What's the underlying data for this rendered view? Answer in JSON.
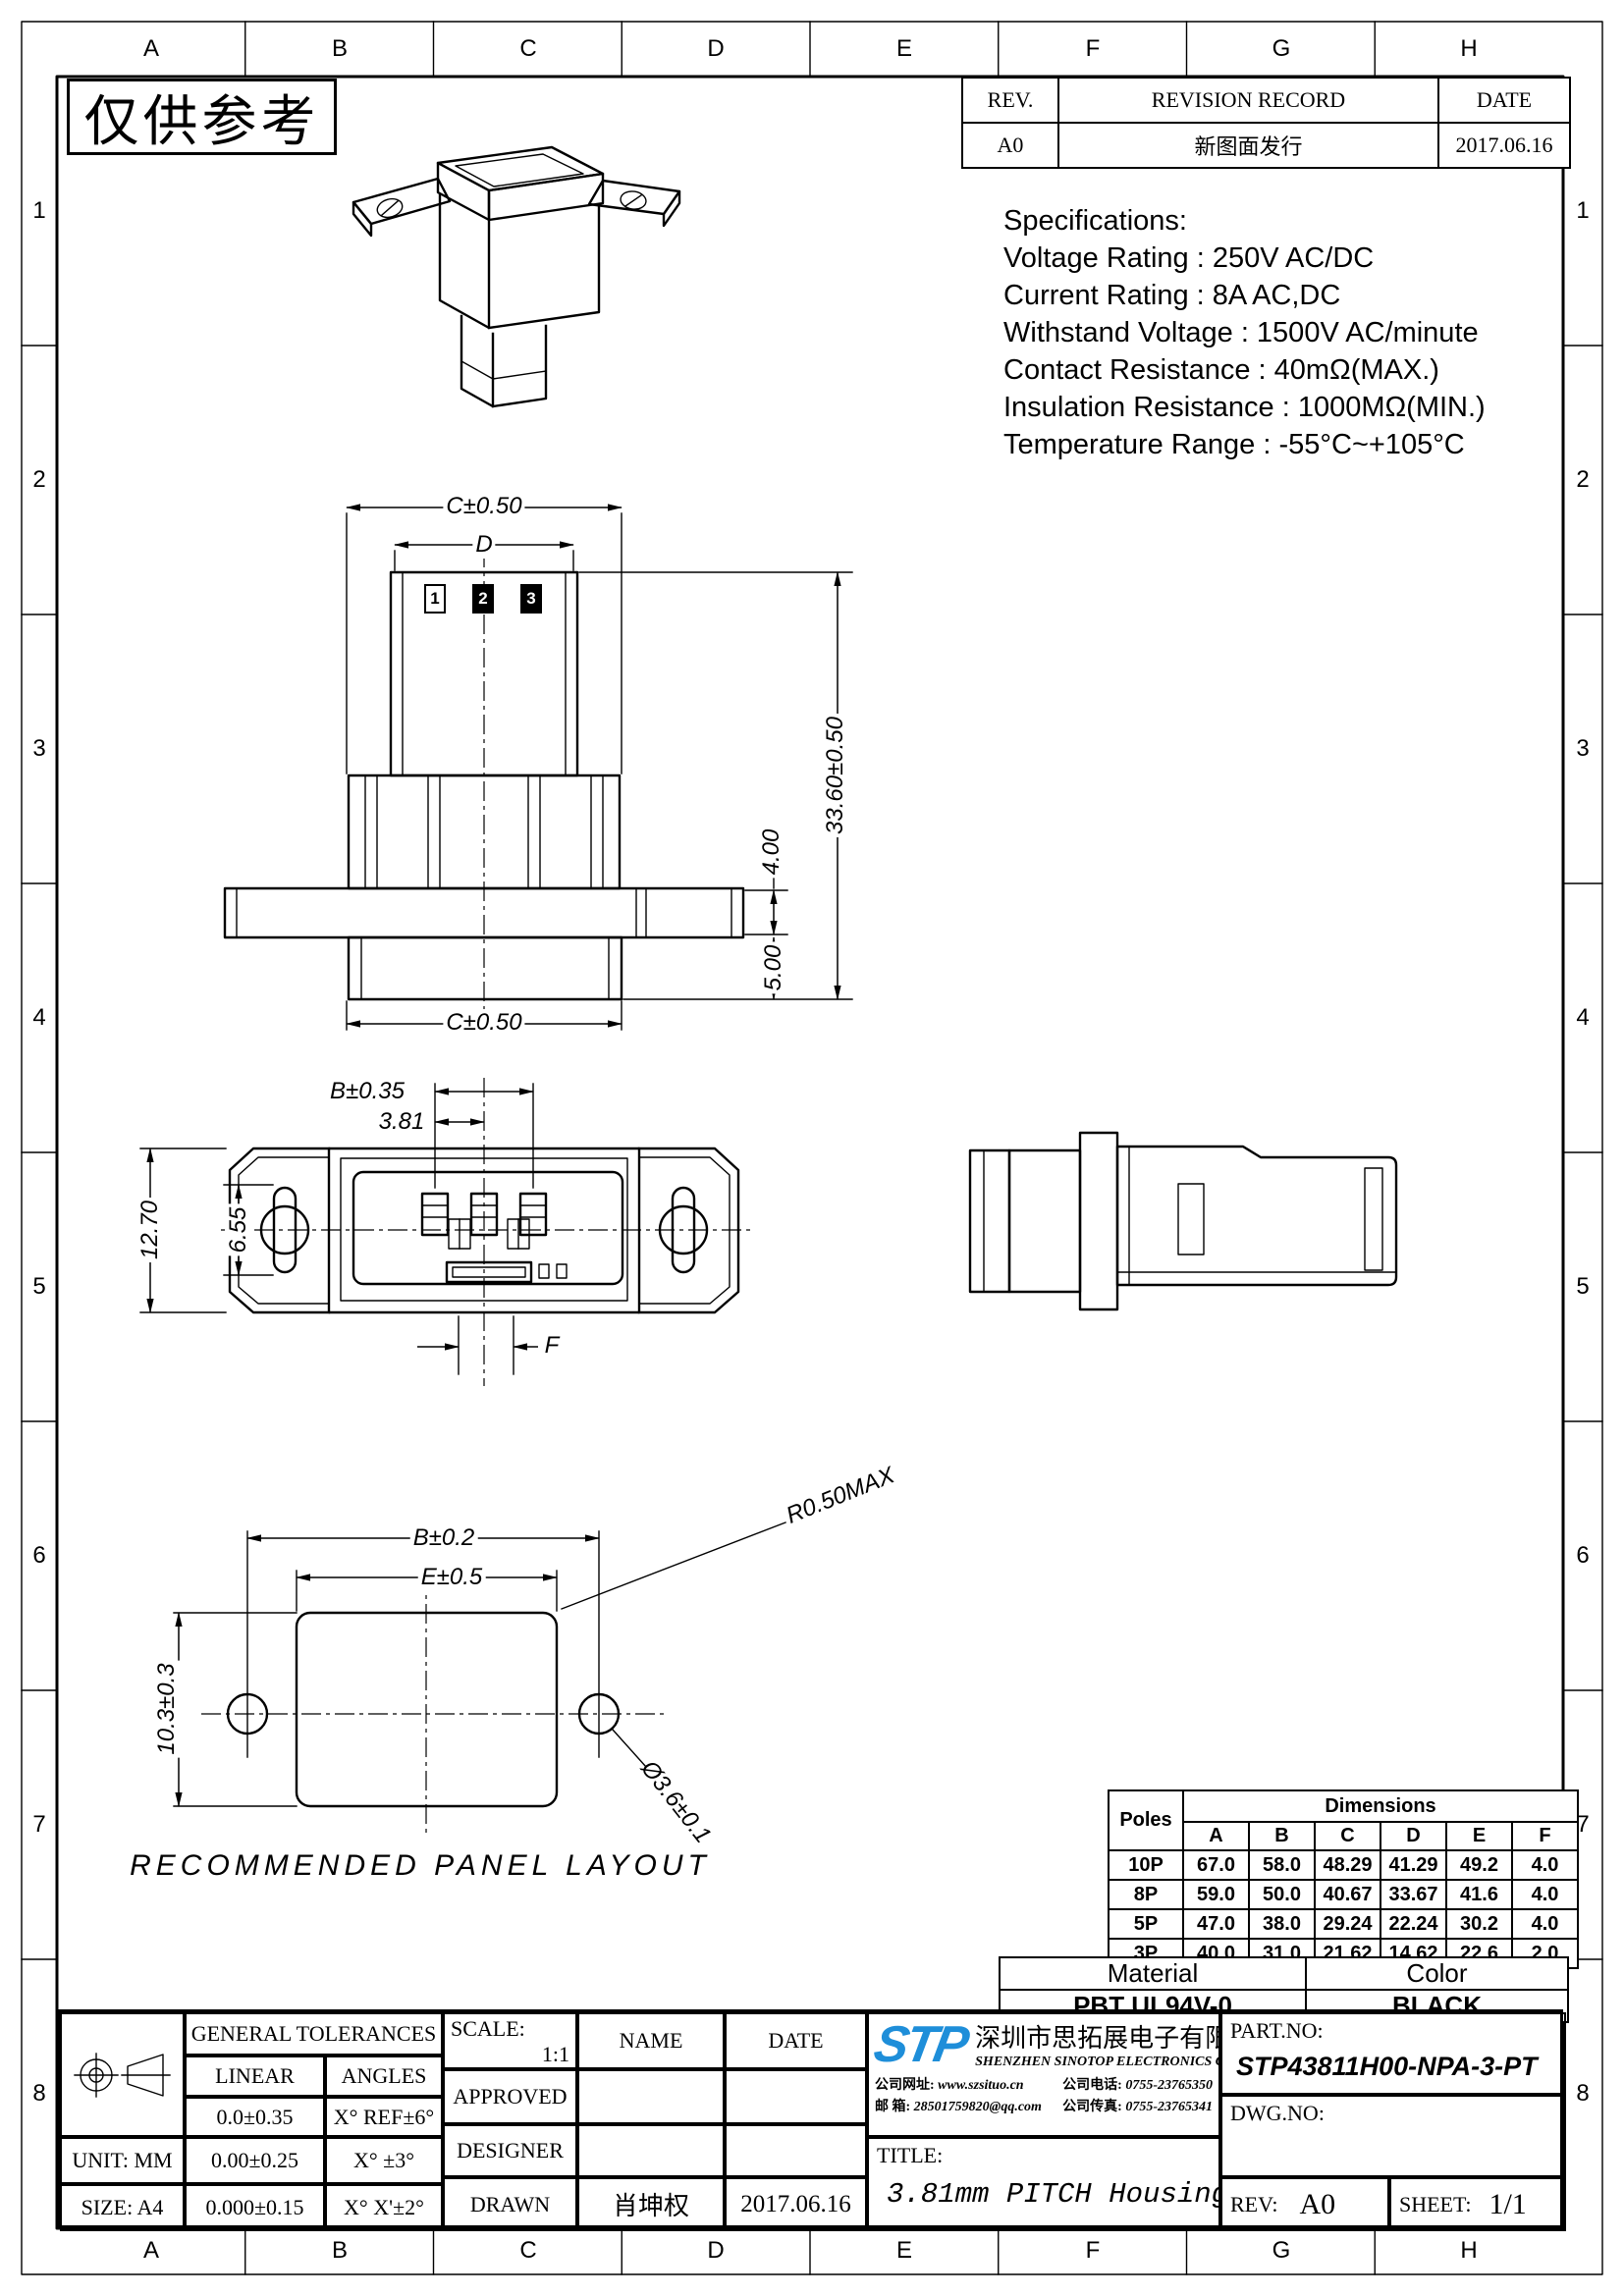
{
  "sheet": {
    "stamp": "仅供参考",
    "zone_letters": [
      "A",
      "B",
      "C",
      "D",
      "E",
      "F",
      "G",
      "H"
    ],
    "zone_numbers": [
      "1",
      "2",
      "3",
      "4",
      "5",
      "6",
      "7",
      "8"
    ]
  },
  "revision_table": {
    "headers": {
      "rev": "REV.",
      "record": "REVISION RECORD",
      "date": "DATE"
    },
    "row": {
      "rev": "A0",
      "record": "新图面发行",
      "date": "2017.06.16"
    }
  },
  "specifications": {
    "title": "Specifications:",
    "lines": [
      "Voltage Rating : 250V AC/DC",
      "Current Rating : 8A AC,DC",
      "Withstand Voltage : 1500V AC/minute",
      "Contact Resistance : 40mΩ(MAX.)",
      "Insulation Resistance : 1000MΩ(MIN.)",
      "Temperature Range : -55°C~+105°C"
    ]
  },
  "drawing": {
    "labels": {
      "c_top": "C±0.50",
      "d": "D",
      "total_height": "33.60±0.50",
      "flange": "4.00",
      "tail": "5.00",
      "c_bottom": "C±0.50",
      "b_pins": "B±0.35",
      "pitch": "3.81",
      "height": "12.70",
      "slot": "6.55",
      "f": "F",
      "panel_b": "B±0.2",
      "panel_e": "E±0.5",
      "panel_r": "R0.50MAX",
      "panel_h": "10.3±0.3",
      "panel_hole": "Ø3.6±0.1",
      "panel_caption": "RECOMMENDED PANEL LAYOUT"
    },
    "pins": [
      "1",
      "2",
      "3"
    ]
  },
  "dim_table": {
    "poles_header": "Poles",
    "dims_header": "Dimensions",
    "cols": [
      "A",
      "B",
      "C",
      "D",
      "E",
      "F"
    ],
    "rows": [
      {
        "pole": "10P",
        "values": [
          "67.0",
          "58.0",
          "48.29",
          "41.29",
          "49.2",
          "4.0"
        ]
      },
      {
        "pole": "8P",
        "values": [
          "59.0",
          "50.0",
          "40.67",
          "33.67",
          "41.6",
          "4.0"
        ]
      },
      {
        "pole": "5P",
        "values": [
          "47.0",
          "38.0",
          "29.24",
          "22.24",
          "30.2",
          "4.0"
        ]
      },
      {
        "pole": "3P",
        "values": [
          "40.0",
          "31.0",
          "21.62",
          "14.62",
          "22.6",
          "2.0"
        ]
      }
    ]
  },
  "material_table": {
    "material_header": "Material",
    "color_header": "Color",
    "material": "PBT UL94V-0",
    "color": "BLACK"
  },
  "title_block": {
    "general_tolerances": "GENERAL TOLERANCES",
    "linear": "LINEAR",
    "angles": "ANGLES",
    "tol_rows": [
      [
        "0.0±0.35",
        "X° REF±6°"
      ],
      [
        "0.00±0.25",
        "X° ±3°"
      ],
      [
        "0.000±0.15",
        "X° X'±2°"
      ]
    ],
    "unit": "UNIT: MM",
    "size": "SIZE: A4",
    "scale_label": "SCALE:",
    "scale_value": "1:1",
    "approved": "APPROVED",
    "designer": "DESIGNER",
    "drawn": "DRAWN",
    "name_header": "NAME",
    "date_header": "DATE",
    "drawn_name": "肖坤权",
    "drawn_date": "2017.06.16",
    "company": {
      "logo": "STP",
      "name_cn": "深圳市思拓展电子有限公司",
      "name_en": "SHENZHEN SINOTOP ELECTRONICS CO.,LTD",
      "web_label": "公司网址:",
      "web": "www.szsituo.cn",
      "tel_label": "公司电话:",
      "tel": "0755-23765350",
      "mail_label": "邮 箱:",
      "mail": "28501759820@qq.com",
      "fax_label": "公司传真:",
      "fax": "0755-23765341"
    },
    "title_label": "TITLE:",
    "title_value": "3.81mm PITCH Housing",
    "part_no_label": "PART.NO:",
    "part_no": "STP43811H00-NPA-3-PT",
    "dwg_no_label": "DWG.NO:",
    "rev_label": "REV:",
    "rev_value": "A0",
    "sheet_label": "SHEET:",
    "sheet_value": "1/1"
  },
  "colors": {
    "logo_blue": "#1e8ed9"
  }
}
